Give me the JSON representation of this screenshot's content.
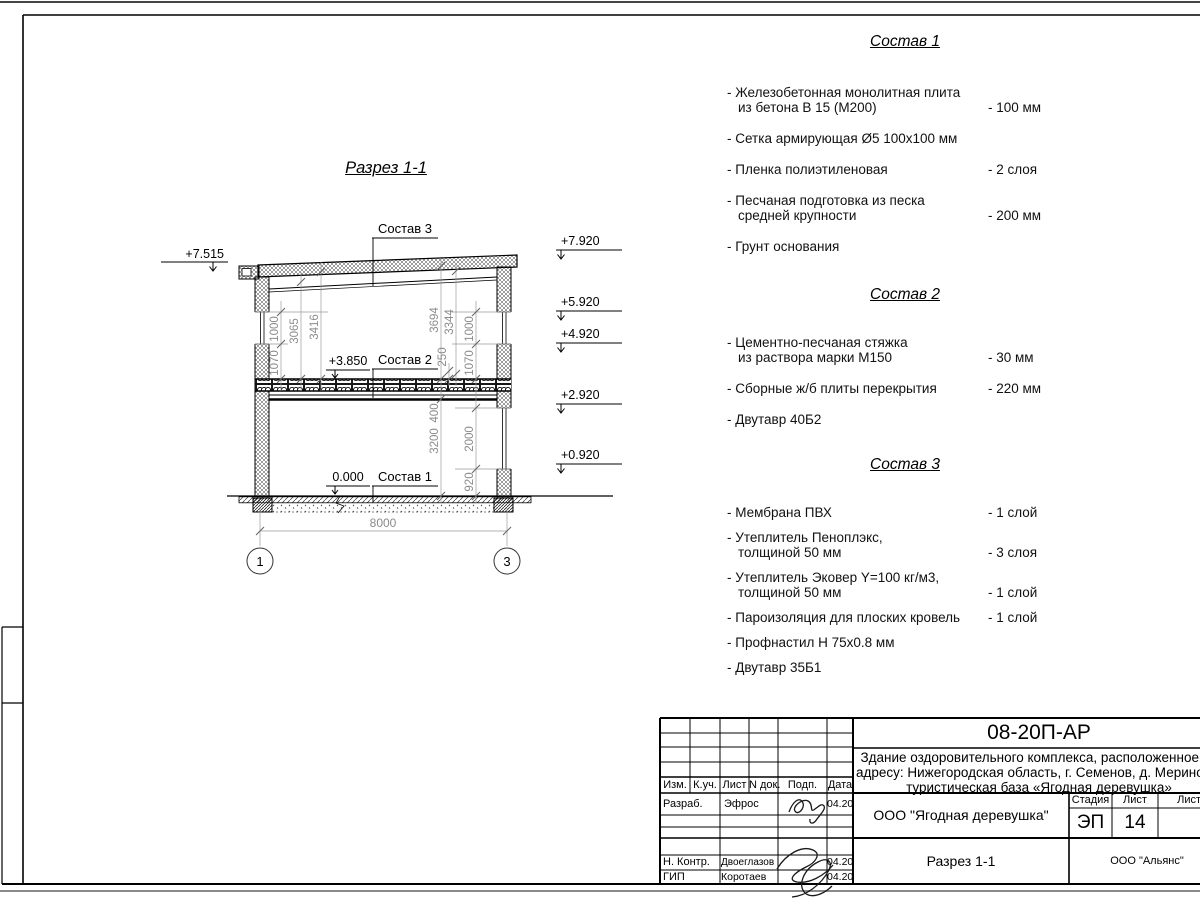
{
  "drawing": {
    "title": "Разрез 1-1",
    "labels": {
      "sostav1": "Состав 1",
      "sostav2": "Состав 2",
      "sostav3": "Состав 3"
    },
    "levels": {
      "l7515": "+7.515",
      "l7920": "+7.920",
      "l5920": "+5.920",
      "l4920": "+4.920",
      "l2920": "+2.920",
      "l0920": "+0.920",
      "l3850": "+3.850",
      "l0000": "0.000"
    },
    "dims": {
      "w1000l": "1000",
      "w1070l": "1070",
      "h3065": "3065",
      "h3416": "3416",
      "h3694": "3694",
      "h3344": "3344",
      "h250": "250",
      "w1000r": "1000",
      "w1070r": "1070",
      "h400": "400",
      "h3200": "3200",
      "h2000": "2000",
      "h920": "920",
      "span": "8000"
    },
    "axes": {
      "a1": "1",
      "a2": "3"
    }
  },
  "specs": [
    {
      "title": "Состав 1",
      "items": [
        {
          "l1": "- Железобетонная  монолитная плита",
          "l2": "из бетона В 15 (М200)",
          "val": "- 100 мм"
        },
        {
          "l1": "- Сетка армирующая Ø5 100х100 мм"
        },
        {
          "l1": "- Пленка полиэтиленовая",
          "val": "-  2 слоя"
        },
        {
          "l1": "- Песчаная подготовка из песка",
          "l2": "средней крупности",
          "val": "- 200 мм"
        },
        {
          "l1": "- Грунт основания"
        }
      ]
    },
    {
      "title": "Состав 2",
      "items": [
        {
          "l1": "- Цементно-песчаная стяжка",
          "l2": "из раствора марки М150",
          "val": "- 30 мм"
        },
        {
          "l1": "- Сборные ж/б плиты перекрытия",
          "val": "- 220 мм"
        },
        {
          "l1": "- Двутавр 40Б2"
        }
      ]
    },
    {
      "title": "Состав 3",
      "items": [
        {
          "l1": "- Мембрана ПВХ",
          "val": "- 1 слой"
        },
        {
          "l1": "- Утеплитель Пеноплэкс,",
          "l2": "толщиной 50 мм",
          "val": "- 3 слоя"
        },
        {
          "l1": "- Утеплитель Эковер Y=100 кг/м3,",
          "l2": "толщиной 50 мм",
          "val": "- 1 слой"
        },
        {
          "l1": "- Пароизоляция для плоских кровель",
          "val": "- 1 слой"
        },
        {
          "l1": "- Профнастил Н 75х0.8 мм"
        },
        {
          "l1": "- Двутавр 35Б1"
        }
      ]
    }
  ],
  "titleblock": {
    "doc_number": "08-20П-АР",
    "desc_line1": "Здание оздоровительного комплекса, расположенное по",
    "desc_line2": "адресу: Нижегородская область, г. Семенов, д. Мериново,",
    "desc_line3": "туристическая база «Ягодная деревушка»",
    "org": "ООО \"Ягодная деревушка\"",
    "stage_label": "Стадия",
    "sheet_label": "Лист",
    "sheets_label": "Листов",
    "stage": "ЭП",
    "sheet_num": "14",
    "section_title": "Разрез 1-1",
    "contractor": "ООО \"Альянс\"",
    "col_izm": "Изм.",
    "col_kuch": "К.уч.",
    "col_list": "Лист",
    "col_ndoc": "N док.",
    "col_podp": "Подп.",
    "col_data": "Дата",
    "rows": [
      {
        "role": "Разраб.",
        "name": "Эфрос",
        "date": "04.20"
      },
      {
        "role": "Н. Контр.",
        "name": "Двоеглазов",
        "date": "04.20"
      },
      {
        "role": "ГИП",
        "name": "Коротаев",
        "date": "04.20"
      }
    ]
  }
}
